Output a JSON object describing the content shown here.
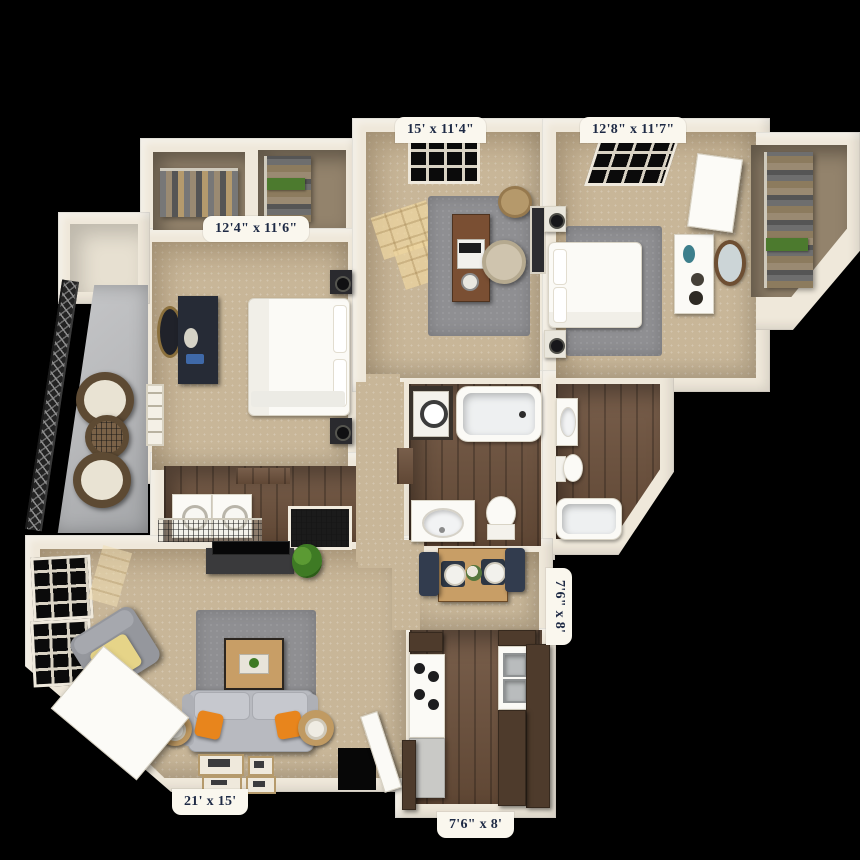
{
  "scene": {
    "description": "3D bird's-eye rendering of a two-bedroom, two-bath apartment floor plan with balcony, on a black background"
  },
  "room_labels": {
    "office_top": "15' x 11'4\"",
    "bedroom_top_right": "12'8\" x 11'7\"",
    "bedroom_left": "12'4\" x 11'6\"",
    "dining_side": "7'6\" x 8'",
    "living_bottom": "21' x 15'",
    "kitchen_bottom": "7'6\" x 8'"
  },
  "colors": {
    "background": "#000000",
    "wall": "#efe8da",
    "carpet": "#c8b698",
    "wood": "#6d513c",
    "rug": "#8f8f92",
    "balcony_floor": "#b7b8ba",
    "label_bg": "#faf7ee",
    "label_text": "#1e2a45",
    "sofa_gray": "#b8bac0",
    "pillow_orange": "#e8851c",
    "table_wood": "#c89e66",
    "cabinet_dark": "#4e3b2c",
    "dresser_navy": "#262b36",
    "chair_navy": "#323c4e",
    "plant_green": "#3e7a24"
  }
}
